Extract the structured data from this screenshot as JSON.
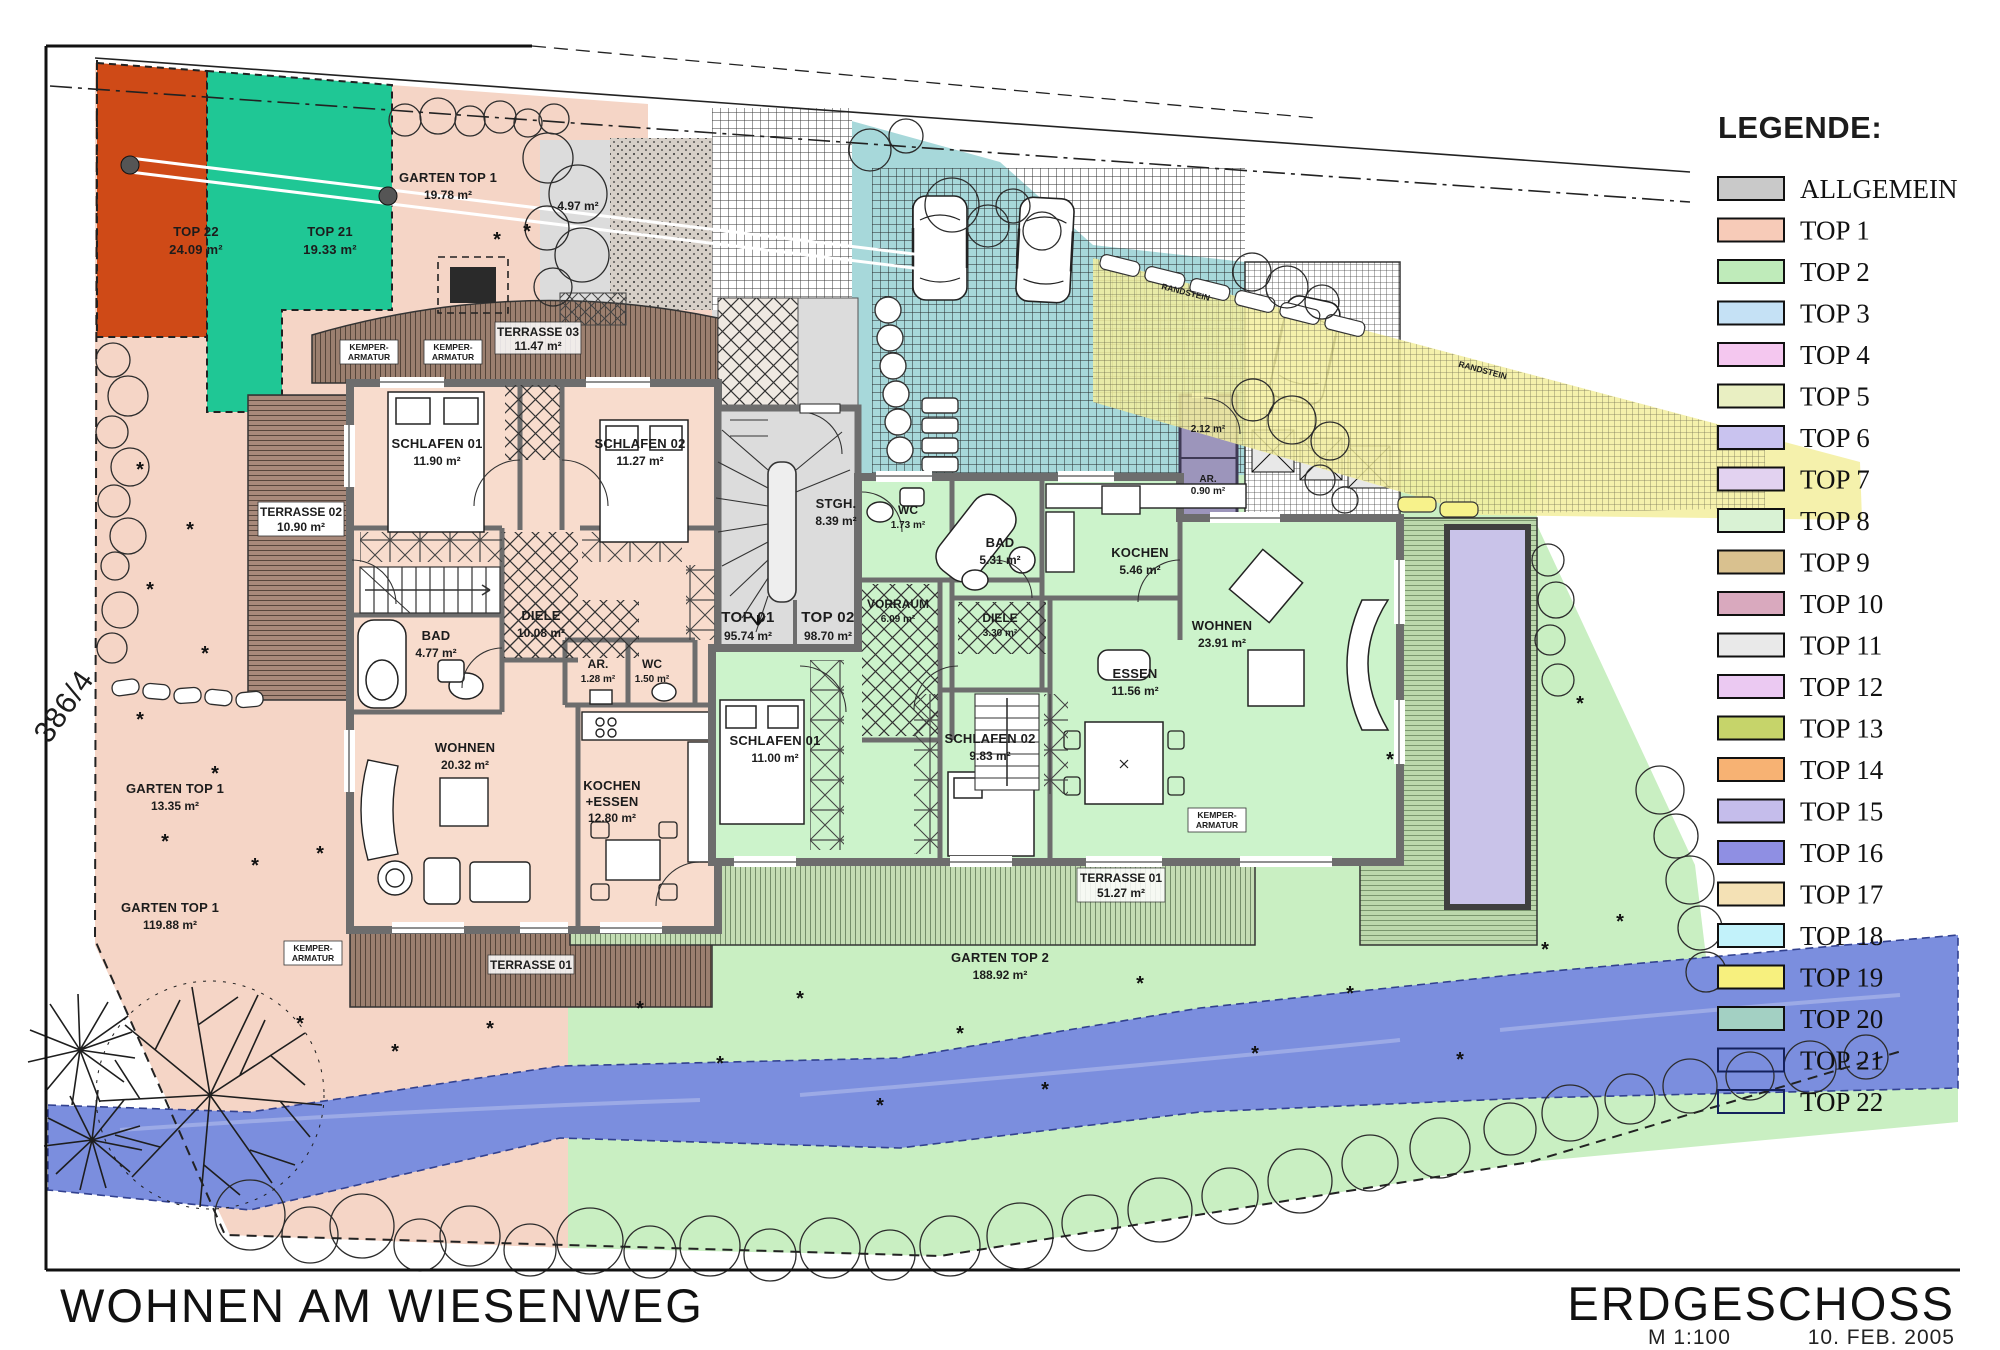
{
  "titles": {
    "project": "WOHNEN AM WIESENWEG",
    "sheet": "ERDGESCHOSS",
    "scale": "M 1:100",
    "date": "10. FEB. 2005"
  },
  "parcel_number": "386/4",
  "legend": {
    "title": "LEGENDE:",
    "items": [
      {
        "label": "ALLGEMEIN",
        "color": "#c9c9c9"
      },
      {
        "label": "TOP 1",
        "color": "#f7cbb8"
      },
      {
        "label": "TOP 2",
        "color": "#bfebba"
      },
      {
        "label": "TOP 3",
        "color": "#c5e1f5"
      },
      {
        "label": "TOP 4",
        "color": "#f4c7ef"
      },
      {
        "label": "TOP 5",
        "color": "#e9efc2"
      },
      {
        "label": "TOP 6",
        "color": "#c9c3ef"
      },
      {
        "label": "TOP 7",
        "color": "#e2d2f0"
      },
      {
        "label": "TOP 8",
        "color": "#d9f2d4"
      },
      {
        "label": "TOP 9",
        "color": "#d9c18f"
      },
      {
        "label": "TOP 10",
        "color": "#d9a9be"
      },
      {
        "label": "TOP 11",
        "color": "#e9e9e9"
      },
      {
        "label": "TOP 12",
        "color": "#ebc9f2"
      },
      {
        "label": "TOP 13",
        "color": "#c6d46a"
      },
      {
        "label": "TOP 14",
        "color": "#f7b273"
      },
      {
        "label": "TOP 15",
        "color": "#c5bdeb"
      },
      {
        "label": "TOP 16",
        "color": "#8f8fe3"
      },
      {
        "label": "TOP 17",
        "color": "#f4e1b5"
      },
      {
        "label": "TOP 18",
        "color": "#c2f2fa"
      },
      {
        "label": "TOP 19",
        "color": "#f7f07e"
      },
      {
        "label": "TOP 20",
        "color": "#a3d0c3"
      },
      {
        "label": "TOP 21",
        "color": "none"
      },
      {
        "label": "TOP 22",
        "color": "none"
      }
    ]
  },
  "site": {
    "top22": {
      "name": "TOP 22",
      "area": "24.09 m²"
    },
    "top21": {
      "name": "TOP 21",
      "area": "19.33 m²"
    },
    "garten1a": {
      "name": "GARTEN TOP 1",
      "area": "19.78 m²"
    },
    "garten1b": {
      "name": "GARTEN TOP 1",
      "area": "13.35 m²"
    },
    "garten1c": {
      "name": "GARTEN TOP 1",
      "area": "119.88 m²"
    },
    "garten2": {
      "name": "GARTEN TOP 2",
      "area": "188.92 m²"
    },
    "entry_area": "4.97 m²",
    "randstein": "RANDSTEIN",
    "kemper1": "KEMPER-",
    "kemper2": "ARMATUR"
  },
  "common": {
    "stgh": {
      "name": "STGH.",
      "area": "8.39 m²"
    },
    "unit1": {
      "name": "TOP 01",
      "area": "95.74 m²"
    },
    "unit2": {
      "name": "TOP 02",
      "area": "98.70 m²"
    },
    "ar_a": {
      "area": "2.12 m²"
    },
    "ar_b": {
      "name": "AR.",
      "area": "0.90 m²"
    }
  },
  "top01": {
    "schlafen1": {
      "name": "SCHLAFEN 01",
      "area": "11.90 m²"
    },
    "schlafen2": {
      "name": "SCHLAFEN 02",
      "area": "11.27 m²"
    },
    "bad": {
      "name": "BAD",
      "area": "4.77 m²"
    },
    "diele": {
      "name": "DIELE",
      "area": "10.08 m²"
    },
    "ar": {
      "name": "AR.",
      "area": "1.28 m²"
    },
    "wc": {
      "name": "WC",
      "area": "1.50 m²"
    },
    "wohnen": {
      "name": "WOHNEN",
      "area": "20.32 m²"
    },
    "kochen": {
      "name": "KOCHEN",
      "name2": "+ESSEN",
      "area": "12.80 m²"
    },
    "terrasse2": {
      "name": "TERRASSE 02",
      "area": "10.90 m²"
    },
    "terrasse3": {
      "name": "TERRASSE 03",
      "area": "11.47 m²"
    },
    "terrasse1": {
      "name": "TERRASSE 01"
    }
  },
  "top02": {
    "wc": {
      "name": "WC",
      "area": "1.73 m²"
    },
    "bad": {
      "name": "BAD",
      "area": "5.31 m²"
    },
    "kochen": {
      "name": "KOCHEN",
      "area": "5.46 m²"
    },
    "vorraum": {
      "name": "VORRAUM",
      "area": "6.09 m²"
    },
    "diele": {
      "name": "DIELE",
      "area": "3.30 m²"
    },
    "essen": {
      "name": "ESSEN",
      "area": "11.56 m²"
    },
    "wohnen": {
      "name": "WOHNEN",
      "area": "23.91 m²"
    },
    "schlafen1": {
      "name": "SCHLAFEN 01",
      "area": "11.00 m²"
    },
    "schlafen2": {
      "name": "SCHLAFEN 02",
      "area": "9.83 m²"
    },
    "terrasse1": {
      "name": "TERRASSE 01",
      "area": "51.27 m²"
    }
  },
  "colors": {
    "red": "#cf4a17",
    "green21": "#1fc795",
    "pink": "#f5d5c6",
    "pink_bldg": "#f8dccd",
    "green": "#c9efc2",
    "green_bldg": "#ccf3cb",
    "gray": "#dcdcdc",
    "teal": "#a7d8da",
    "purple": "#9c95bb",
    "yellow": "#f3ee9e",
    "pool": "#c9c3e9",
    "river": "#7b8ede"
  }
}
